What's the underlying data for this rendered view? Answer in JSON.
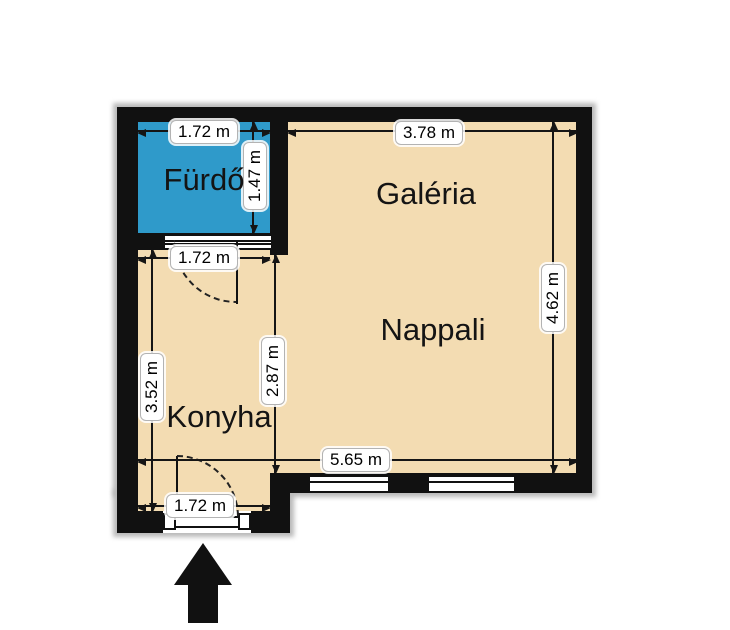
{
  "rooms": {
    "bathroom": "Fürdő",
    "gallery": "Galéria",
    "living_room": "Nappali",
    "kitchen": "Konyha"
  },
  "dimensions": {
    "bathroom_width": "1.72 m",
    "bathroom_height": "1.47 m",
    "gallery_width": "3.78 m",
    "living_height": "4.62 m",
    "kitchen_width": "1.72 m",
    "kitchen_height": "3.52 m",
    "kitchen_living_depth": "2.87 m",
    "living_width": "5.65 m",
    "entrance_width": "1.72 m"
  },
  "colors": {
    "wall": "#111111",
    "floor_fill": "#f3dcb2",
    "bathroom_fill": "#2f9aca"
  },
  "icons": {
    "entrance_arrow": "up-arrow"
  }
}
